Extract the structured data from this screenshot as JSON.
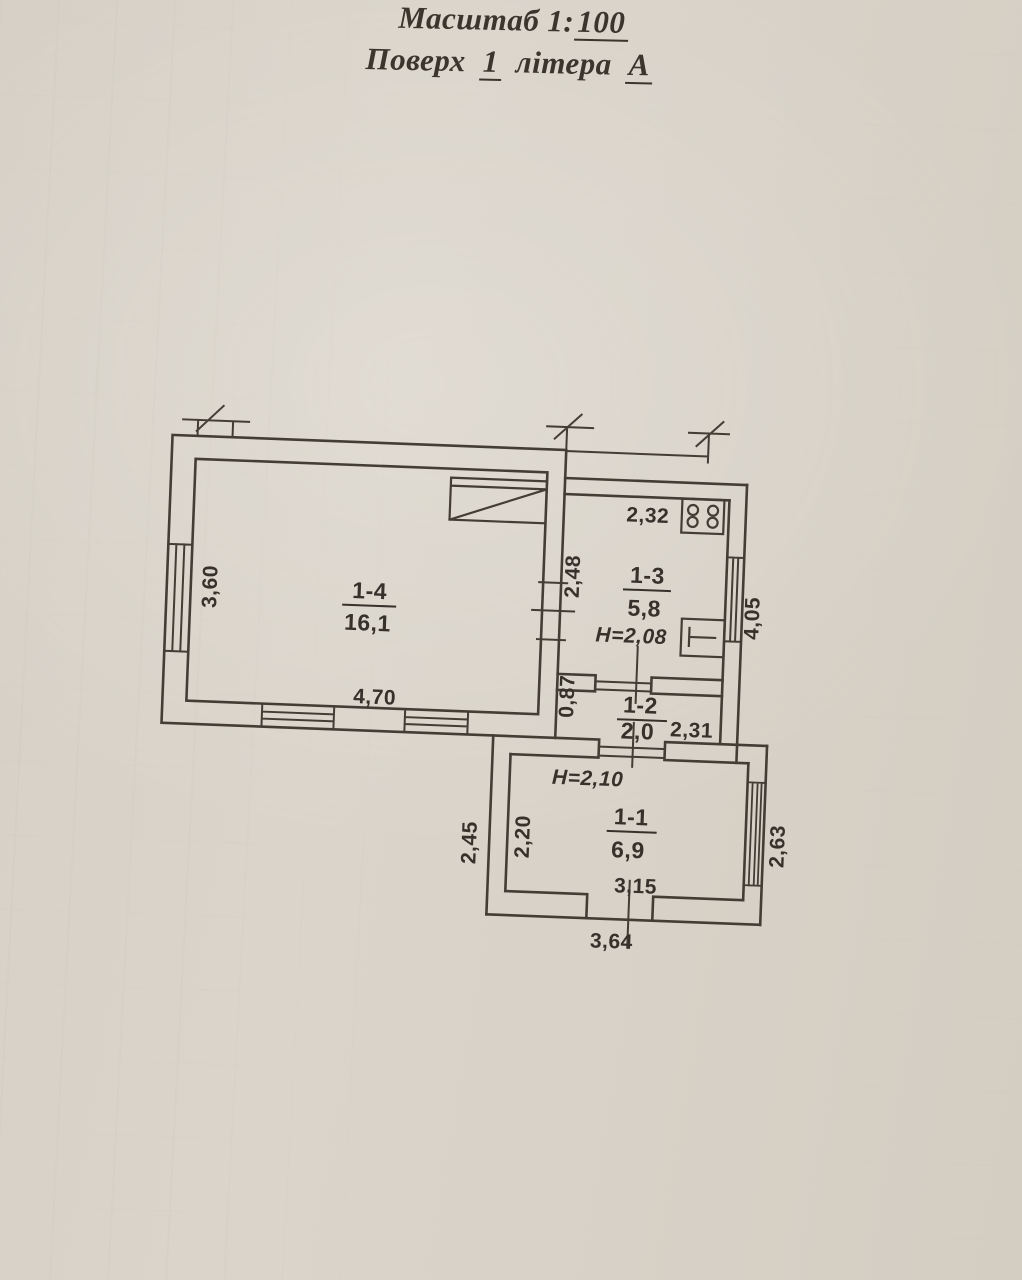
{
  "title": {
    "line1_prefix": "Масштаб 1:",
    "line1_scale": "100",
    "line2_word1": "Поверх",
    "line2_floor": "1",
    "line2_word2": "літера",
    "line2_letter": "А"
  },
  "rooms": {
    "r14": {
      "label": "1-4",
      "area": "16,1"
    },
    "r13": {
      "label": "1-3",
      "area": "5,8"
    },
    "r12": {
      "label": "1-2",
      "area": "2,0"
    },
    "r11": {
      "label": "1-1",
      "area": "6,9"
    }
  },
  "dims": {
    "w360": "3,60",
    "w470": "4,70",
    "w248": "2,48",
    "w232": "2,32",
    "w405": "4,05",
    "w087": "0,87",
    "w231": "2,31",
    "w245": "2,45",
    "w220": "2,20",
    "w263": "2,63",
    "w315": "3,15",
    "w364": "3,64",
    "h208": "Н=2,08",
    "h210": "Н=2,10"
  },
  "icons": {
    "stove": "stove-4-burner-icon",
    "sink": "sink-icon"
  },
  "colors": {
    "paper": "#d8d2c8",
    "ink": "#433d35",
    "text": "#36312a"
  }
}
